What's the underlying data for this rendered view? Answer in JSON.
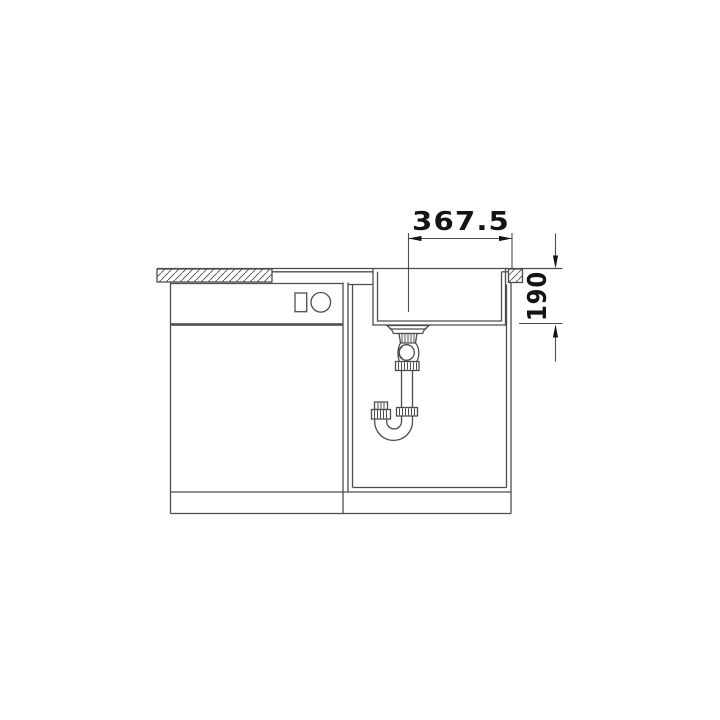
{
  "drawing": {
    "type": "technical-front-view-sink-installation",
    "background": "#ffffff",
    "line_color": "#4d4d4d",
    "thick_line_color": "#565656",
    "text_color": "#141414",
    "dimensions": {
      "width_label": "367.5",
      "depth_label": "190"
    },
    "parts": [
      "countertop-left-section",
      "countertop-right-section",
      "sink-bowl",
      "drain-strainer",
      "s-trap-pipework",
      "left-base-cabinet",
      "right-base-cabinet",
      "plinth",
      "width-dimension",
      "depth-dimension"
    ]
  }
}
